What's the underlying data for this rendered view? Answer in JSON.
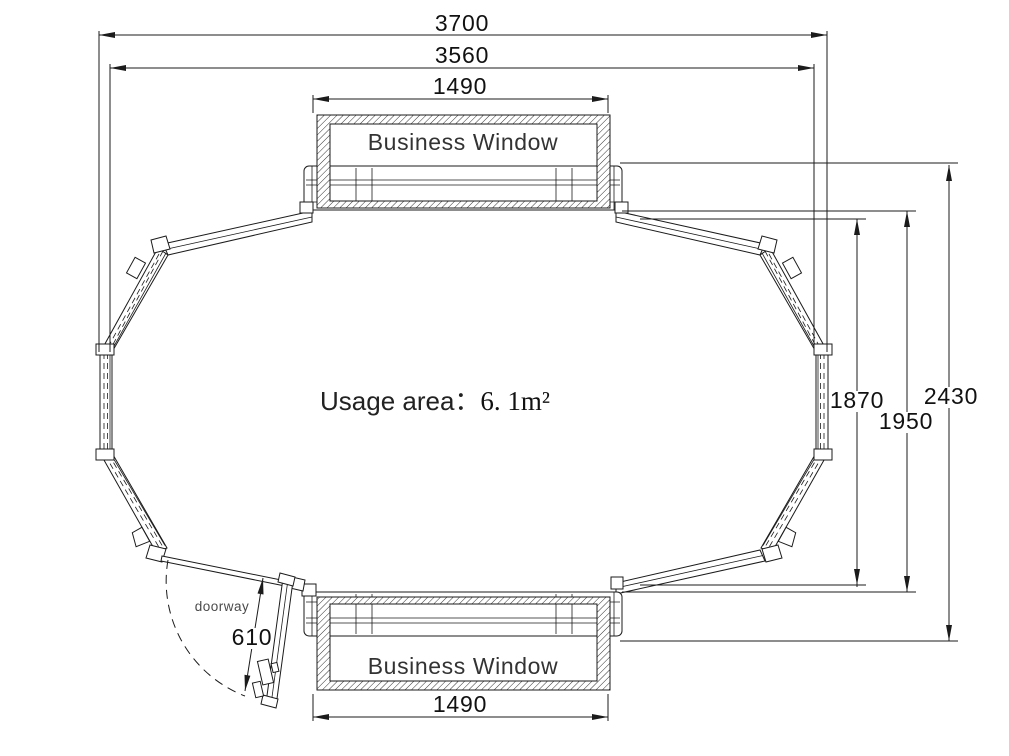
{
  "drawing": {
    "usage": {
      "label": "Usage area：",
      "value": "6. 1m²"
    },
    "windows": {
      "top_label": "Business Window",
      "bottom_label": "Business Window"
    },
    "door": {
      "label": "doorway",
      "width": "610"
    },
    "dims": {
      "overall_width": "3700",
      "glass_width": "3560",
      "top_window_width": "1490",
      "bottom_window_width": "1490",
      "inner_depth": "1870",
      "frame_depth": "1950",
      "overall_depth": "2430"
    },
    "colors": {
      "line": "#1b1b1b",
      "background": "#ffffff"
    }
  }
}
